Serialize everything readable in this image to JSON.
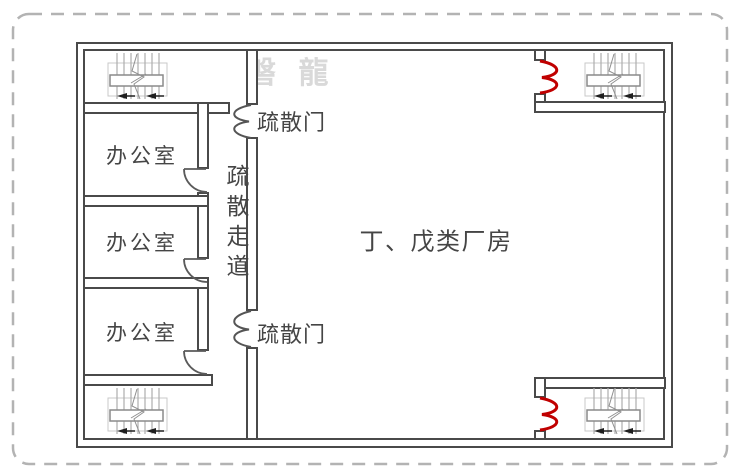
{
  "plan": {
    "title_area": {
      "watermark": "磐 龍"
    },
    "factory": {
      "label": "丁、戊类厂房"
    },
    "corridor": {
      "label": "疏散走道"
    },
    "offices": [
      {
        "label": "办公室"
      },
      {
        "label": "办公室"
      },
      {
        "label": "办公室"
      }
    ],
    "exits": {
      "top": {
        "label": "疏散门"
      },
      "bottom": {
        "label": "疏散门"
      }
    },
    "icons": {
      "stairs-icon": "staircase with treads, landing bar, break line and direction arrows",
      "fire-door-icon": "red double-leaf fire door symbol",
      "double-door-icon": "gray double-leaf evacuation door symbol",
      "office-door-arc-icon": "single door leaf with quarter-circle swing arc"
    },
    "colors": {
      "wall": "#4a4a4a",
      "fire_door_red": "#c00000",
      "text": "#454545",
      "watermark": "#d9d9d9",
      "dashed_border": "#b3b3b3",
      "stair_tread": "#adadad"
    }
  }
}
